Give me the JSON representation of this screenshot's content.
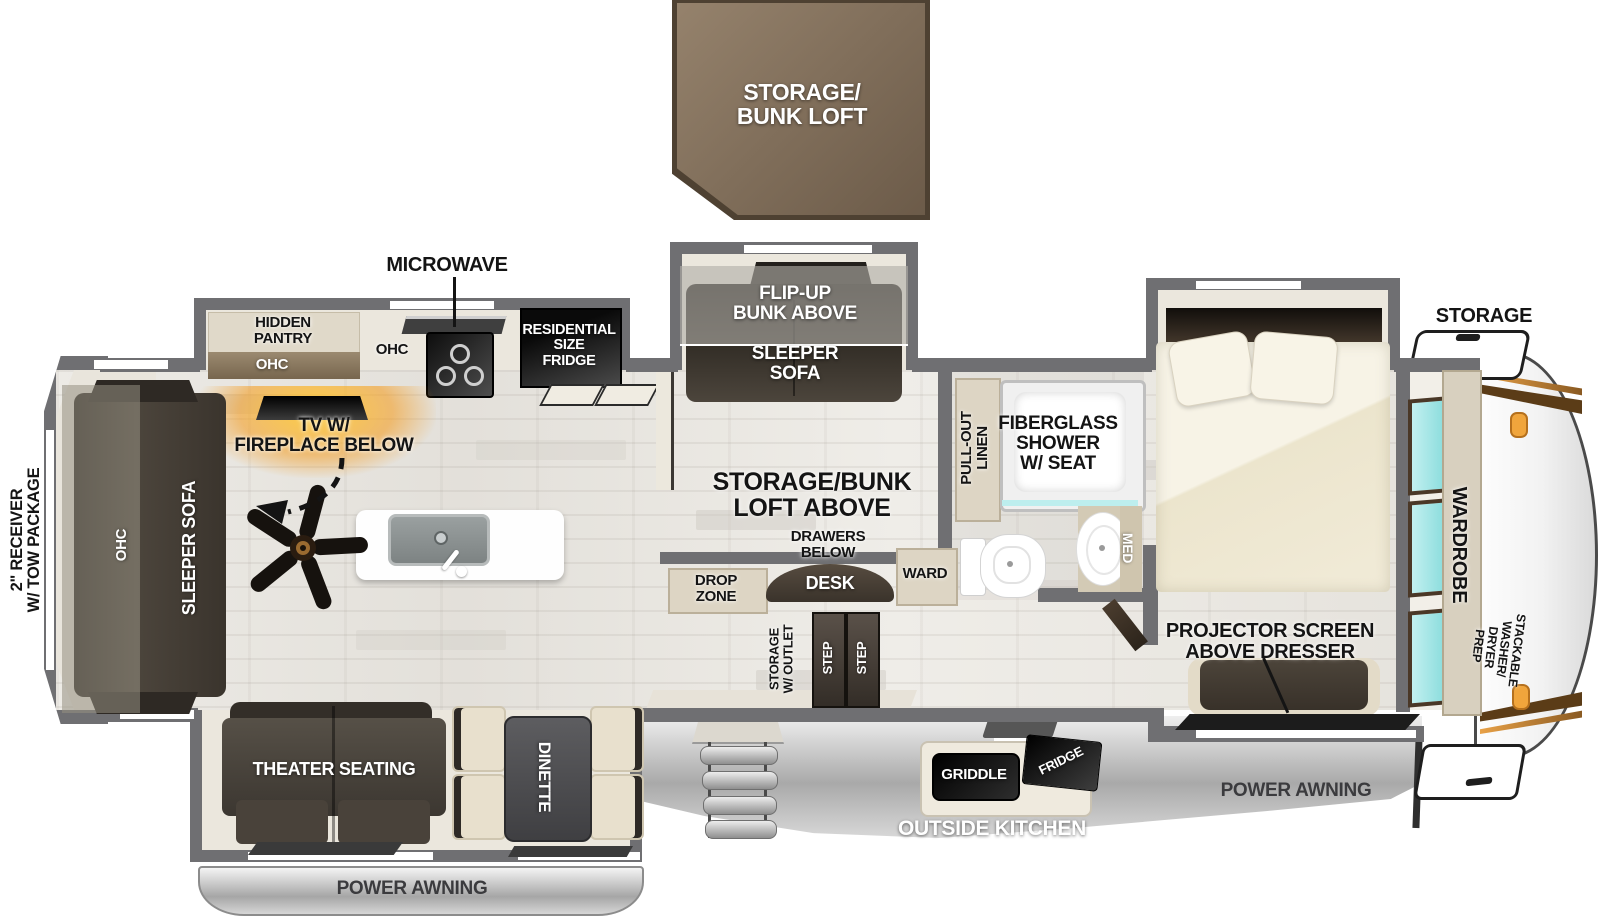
{
  "colors": {
    "wall_gray": "#6f6f72",
    "floor_wood": "#e8e5df",
    "loft_brown": "#8a7760",
    "furniture_dark": "#3f3932",
    "cabinet_tan": "#ddd5c4",
    "window_teal": "#a9e9e9",
    "accent_orange": "#f0a53c",
    "awning_gray": "#c4c4c4"
  },
  "exterior": {
    "loft_label": "STORAGE/\nBUNK LOFT",
    "receiver_label": "2\" RECEIVER\nW/ TOW PACKAGE",
    "storage_label": "STORAGE",
    "awning_left_label": "POWER AWNING",
    "awning_right_label": "POWER AWNING",
    "outside_kitchen": {
      "label": "OUTSIDE KITCHEN",
      "griddle": "GRIDDLE",
      "fridge": "FRIDGE"
    }
  },
  "kitchen": {
    "microwave": "MICROWAVE",
    "hidden_pantry": "HIDDEN\nPANTRY",
    "ohc_pantry": "OHC",
    "ohc_counter": "OHC",
    "residential_fridge": "RESIDENTIAL\nSIZE\nFRIDGE",
    "tv_fireplace": "TV W/\nFIREPLACE BELOW",
    "drop_zone": "DROP\nZONE"
  },
  "living": {
    "ohc": "OHC",
    "sleeper_sofa": "SLEEPER SOFA",
    "theater_seating": "THEATER SEATING",
    "dinette": "DINETTE"
  },
  "bunk_room": {
    "flip_up_bunk": "FLIP-UP\nBUNK ABOVE",
    "sleeper_sofa": "SLEEPER\nSOFA",
    "loft_above": "STORAGE/BUNK\nLOFT ABOVE",
    "drawers_below": "DRAWERS\nBELOW",
    "desk": "DESK",
    "ward": "WARD",
    "storage_outlet": "STORAGE\nW/ OUTLET",
    "step_1": "STEP",
    "step_2": "STEP"
  },
  "bathroom": {
    "pull_out_linen": "PULL-OUT\nLINEN",
    "shower": "FIBERGLASS\nSHOWER\nW/ SEAT",
    "med": "MED"
  },
  "bedroom": {
    "projector": "PROJECTOR SCREEN\nABOVE DRESSER",
    "wardrobe": "WARDROBE",
    "washer_prep": "STACKABLE\nWASHER/\nDRYER\nPREP"
  }
}
